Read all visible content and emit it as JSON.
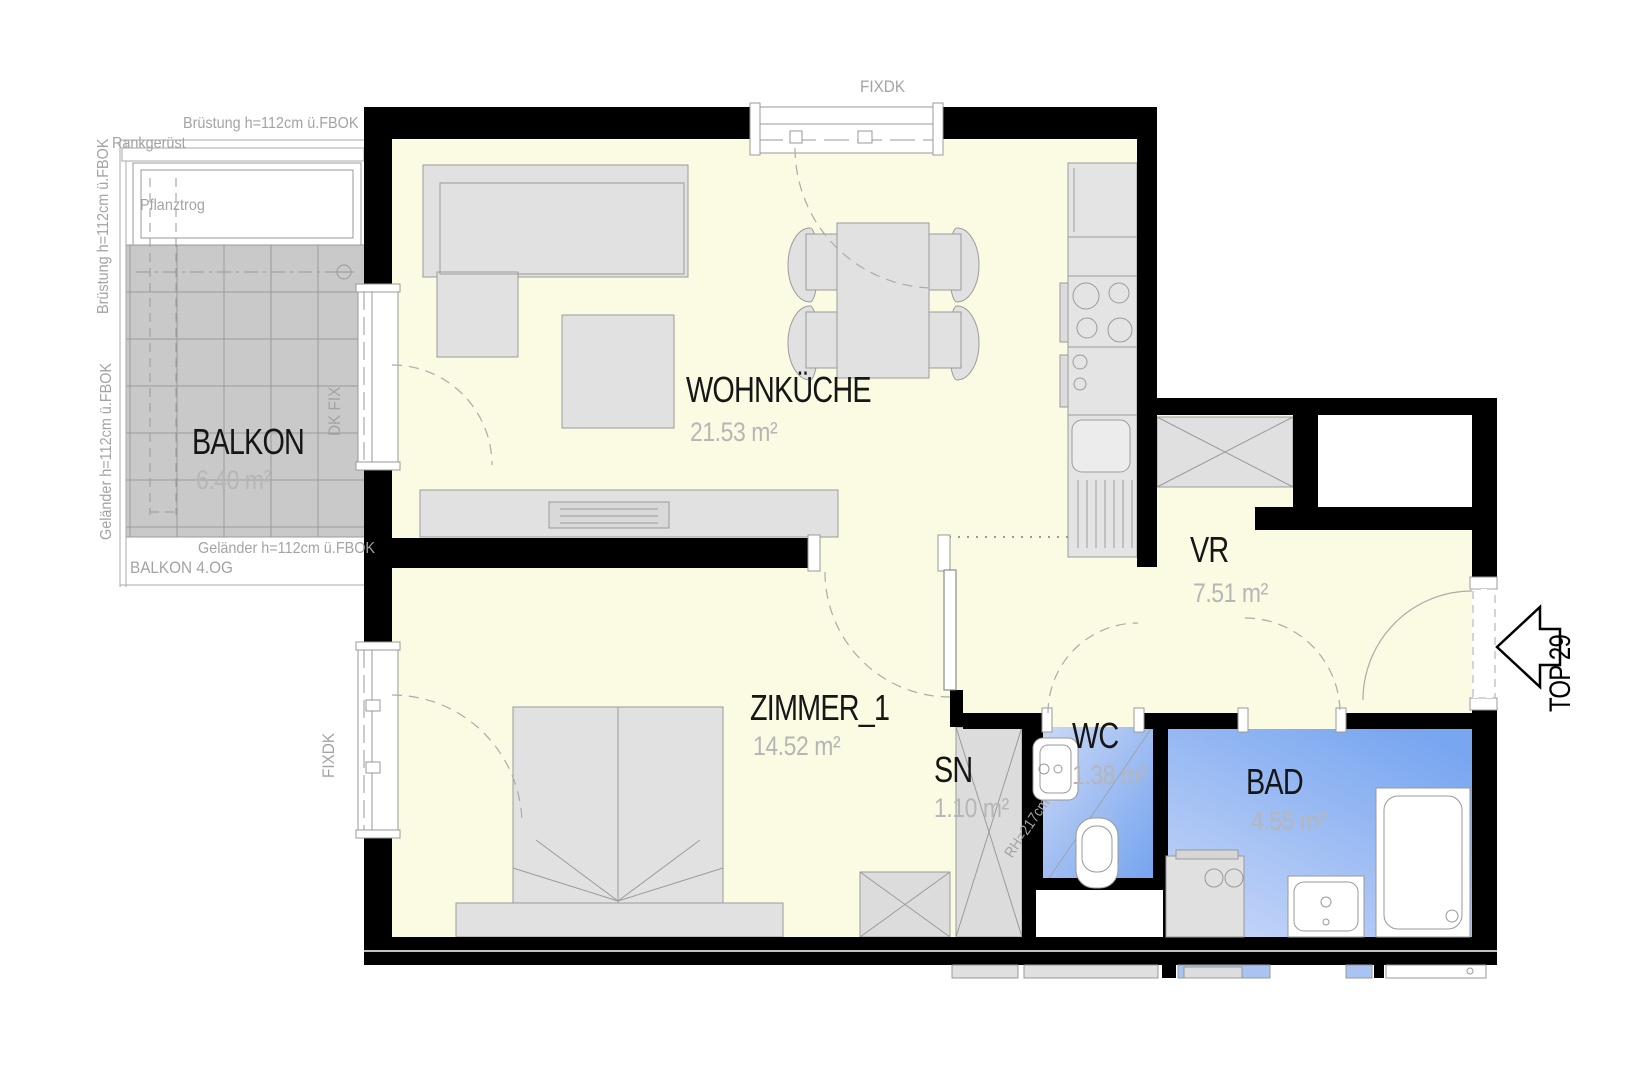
{
  "unit_arrow": {
    "label": "TOP 29"
  },
  "rooms": {
    "wohnkueche": {
      "name": "WOHNKÜCHE",
      "area": "21.53 m²"
    },
    "zimmer1": {
      "name": "ZIMMER_1",
      "area": "14.52 m²"
    },
    "vr": {
      "name": "VR",
      "area": "7.51 m²"
    },
    "sn": {
      "name": "SN",
      "area": "1.10 m²"
    },
    "wc": {
      "name": "WC",
      "area": "1.38 m²",
      "room_height": "RH=217cm"
    },
    "bad": {
      "name": "BAD",
      "area": "4.55 m²"
    },
    "balkon": {
      "name": "BALKON",
      "area": "6.40 m²",
      "floor_label": "BALKON 4.OG"
    }
  },
  "annotations": {
    "parapet_top": "Brüstung h=112cm ü.FBOK",
    "parapet_left": "Brüstung h=112cm ü.FBOK",
    "railing_left": "Geländer h=112cm ü.FBOK",
    "railing_bottom": "Geländer h=112cm ü.FBOK",
    "trellis": "Rankgerüst",
    "planter": "Pflanztrog",
    "window_top": "FIXDK",
    "window_balcony_door": "DK FIX",
    "window_bedroom": "FIXDK"
  },
  "colors": {
    "floor": "#FBFAE2",
    "wall": "#000000",
    "wet_dark": "#77A5EF",
    "wet_light": "#C9D7F4",
    "furniture": "#E1E1E1",
    "balcony_tile": "#C9C9C9"
  }
}
